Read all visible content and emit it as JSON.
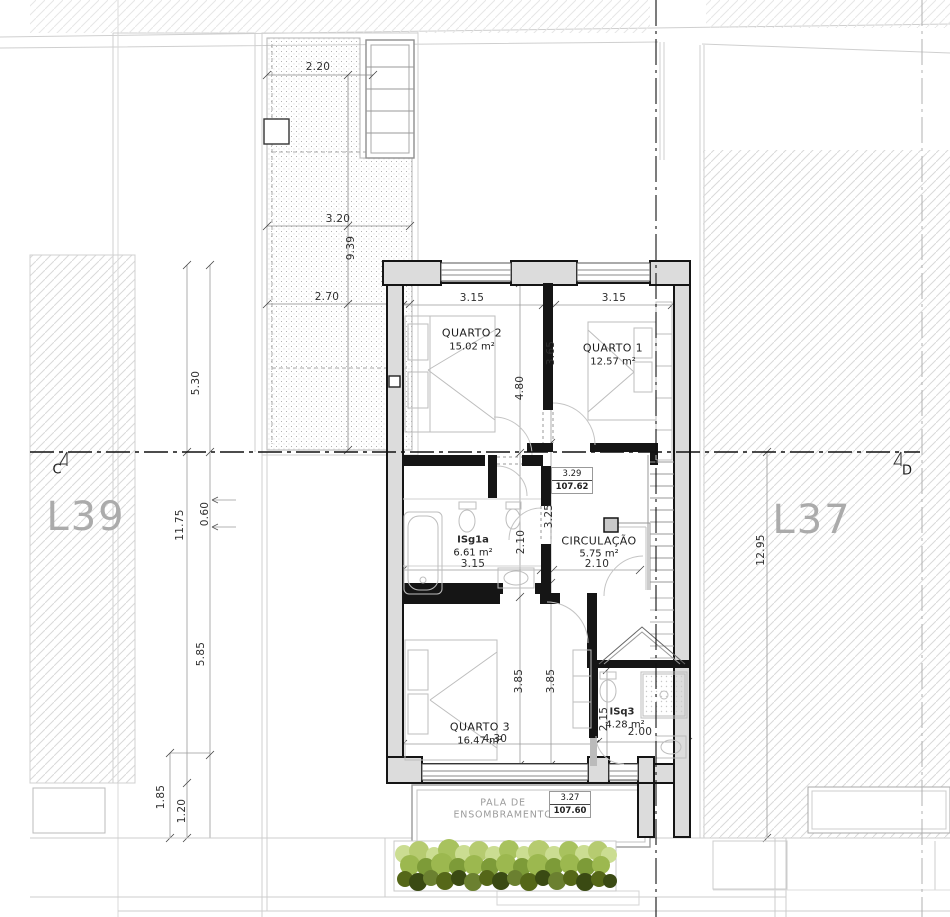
{
  "drawing_type": "architectural floor plan - upper storey",
  "lots": {
    "left": "L39",
    "right": "L37"
  },
  "section_markers": {
    "left": "C",
    "right": "D"
  },
  "rooms": [
    {
      "name": "QUARTO 2",
      "area": "15.02 m²"
    },
    {
      "name": "QUARTO 1",
      "area": "12.57 m²"
    },
    {
      "name": "ISg1a",
      "area": "6.61 m²"
    },
    {
      "name": "CIRCULAÇÃO",
      "area": "5.75 m²"
    },
    {
      "name": "QUARTO 3",
      "area": "16.47 m²"
    },
    {
      "name": "ISq3",
      "area": "4.28 m²"
    }
  ],
  "levels": [
    {
      "height": "3.29",
      "elevation": "107.62"
    },
    {
      "height": "3.27",
      "elevation": "107.60"
    }
  ],
  "shading_canopy": {
    "line1": "PALA DE",
    "line2": "ENSOMBRAMENTO"
  },
  "dims": {
    "site_top_width": "2.20",
    "site_mid_width": "3.20",
    "courtyard_depth": "9.39",
    "site_lower_width": "2.70",
    "left_upper_depth": "5.30",
    "left_total_depth": "11.75",
    "left_offset": "0.60",
    "left_lower_depth": "5.85",
    "bottom_left_a": "1.85",
    "bottom_left_b": "1.20",
    "right_depth": "12.95",
    "q2_width": "3.15",
    "q1_width": "3.15",
    "q2_depth": "4.80",
    "q1_depth": "3.65",
    "hall_depth": "3.25",
    "bath1_depth": "2.10",
    "bath1_width": "3.15",
    "circ_width": "2.10",
    "q3_depth_a": "3.85",
    "q3_depth_b": "3.85",
    "q3_width": "4.30",
    "bath3_depth": "2.15",
    "bath3_width": "2.00"
  },
  "colors": {
    "wall_fill": "#dcdcdc",
    "wall_line": "#151515",
    "hatch": "#d9d9d9",
    "lot_text": "#ababab",
    "veg_light": "#cbdd92",
    "veg_mid": "#9cb84f",
    "veg_dark": "#556718",
    "veg_darkest": "#3a4a13"
  }
}
